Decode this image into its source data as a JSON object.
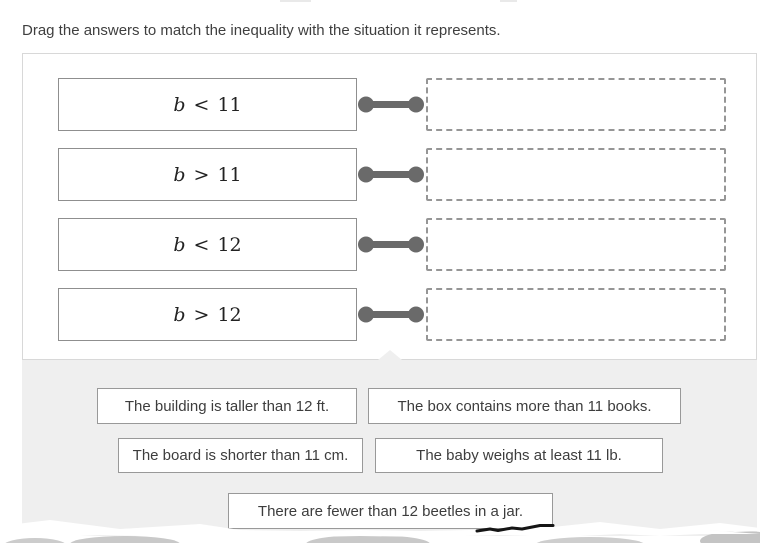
{
  "instruction": "Drag the answers to match the inequality with the situation it represents.",
  "pairs": [
    {
      "var": "b",
      "op": "<",
      "value": "11"
    },
    {
      "var": "b",
      "op": ">",
      "value": "11"
    },
    {
      "var": "b",
      "op": "<",
      "value": "12"
    },
    {
      "var": "b",
      "op": ">",
      "value": "12"
    }
  ],
  "answers": [
    {
      "label": "The building is taller than 12 ft."
    },
    {
      "label": "The box contains more than 11 books."
    },
    {
      "label": "The board is shorter than 11 cm."
    },
    {
      "label": "The baby weighs at least 11 lb."
    },
    {
      "label": "There are fewer than 12 beetles in a jar."
    }
  ],
  "colors": {
    "tray_background": "#efefef",
    "card_border": "#d8d8d8",
    "inequality_box_border": "#8f8f8f",
    "drop_zone_border": "#969696",
    "connector": "#6a6a6a",
    "chip_border": "#999999",
    "text": "#3d3d3d"
  }
}
